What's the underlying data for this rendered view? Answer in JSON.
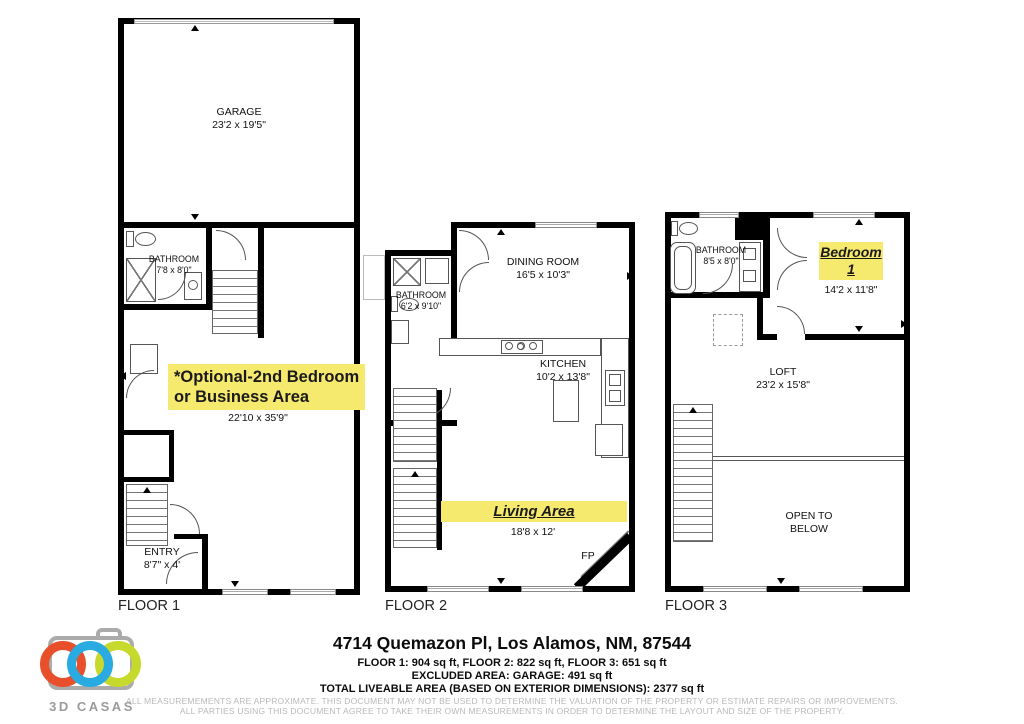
{
  "floors": [
    {
      "label": "FLOOR 1",
      "rooms": {
        "garage": {
          "name": "GARAGE",
          "dims": "23'2 x 19'5\""
        },
        "bathroom": {
          "name": "BATHROOM",
          "dims": "7'8 x 8'0\""
        },
        "flex": {
          "line1": "*Optional-2nd Bedroom",
          "line2": "or  Business Area",
          "dims": "22'10 x 35'9\""
        },
        "entry": {
          "name": "ENTRY",
          "dims": "8'7\"  x 4'"
        }
      }
    },
    {
      "label": "FLOOR 2",
      "rooms": {
        "dining": {
          "name": "DINING ROOM",
          "dims": "16'5 x 10'3\""
        },
        "bathroom": {
          "name": "BATHROOM",
          "dims": "6'2 x 9'10\""
        },
        "kitchen": {
          "name": "KITCHEN",
          "dims": "10'2 x 13'8\""
        },
        "living": {
          "name": "Living Area",
          "dims": "18'8 x 12'"
        },
        "fireplace": {
          "abbr": "FP"
        }
      }
    },
    {
      "label": "FLOOR 3",
      "rooms": {
        "bathroom": {
          "name": "BATHROOM",
          "dims": "8'5 x 8'0\""
        },
        "bedroom": {
          "line1": "Bedroom",
          "line2": "1",
          "dims": "14'2 x 11'8\""
        },
        "loft": {
          "name": "LOFT",
          "dims": "23'2 x 15'8\""
        },
        "open_below": {
          "label": "OPEN TO BELOW"
        }
      }
    }
  ],
  "footer": {
    "address": "4714 Quemazon Pl, Los Alamos, NM, 87544",
    "areas_line": "FLOOR 1: 904 sq ft, FLOOR 2: 822 sq ft, FLOOR 3: 651 sq ft",
    "excluded_line": "EXCLUDED AREA: GARAGE: 491 sq ft",
    "total_line": "TOTAL LIVEABLE AREA (BASED ON EXTERIOR DIMENSIONS): 2377 sq ft",
    "disclaimer_line1": "ALL MEASUREMEMENTS ARE APPROXIMATE. THIS DOCUMENT MAY NOT BE USED TO DETERMINE THE VALUATION OF THE PROPERTY OR ESTIMATE REPAIRS OR IMPROVEMENTS.",
    "disclaimer_line2": "ALL PARTIES USING THIS DOCUMENT AGREE TO TAKE THEIR OWN MEASUREMENTS IN ORDER TO DETERMINE THE LAYOUT AND SIZE OF THE PROPERTY."
  },
  "logo": {
    "brand": "3D CASAS",
    "colors": {
      "camera": "#ababab",
      "ring_orange": "#e8502b",
      "ring_blue": "#29abe2",
      "ring_green": "#c6d92d"
    }
  },
  "style": {
    "highlight_color": "#f5e96e",
    "wall_color": "#000000"
  }
}
